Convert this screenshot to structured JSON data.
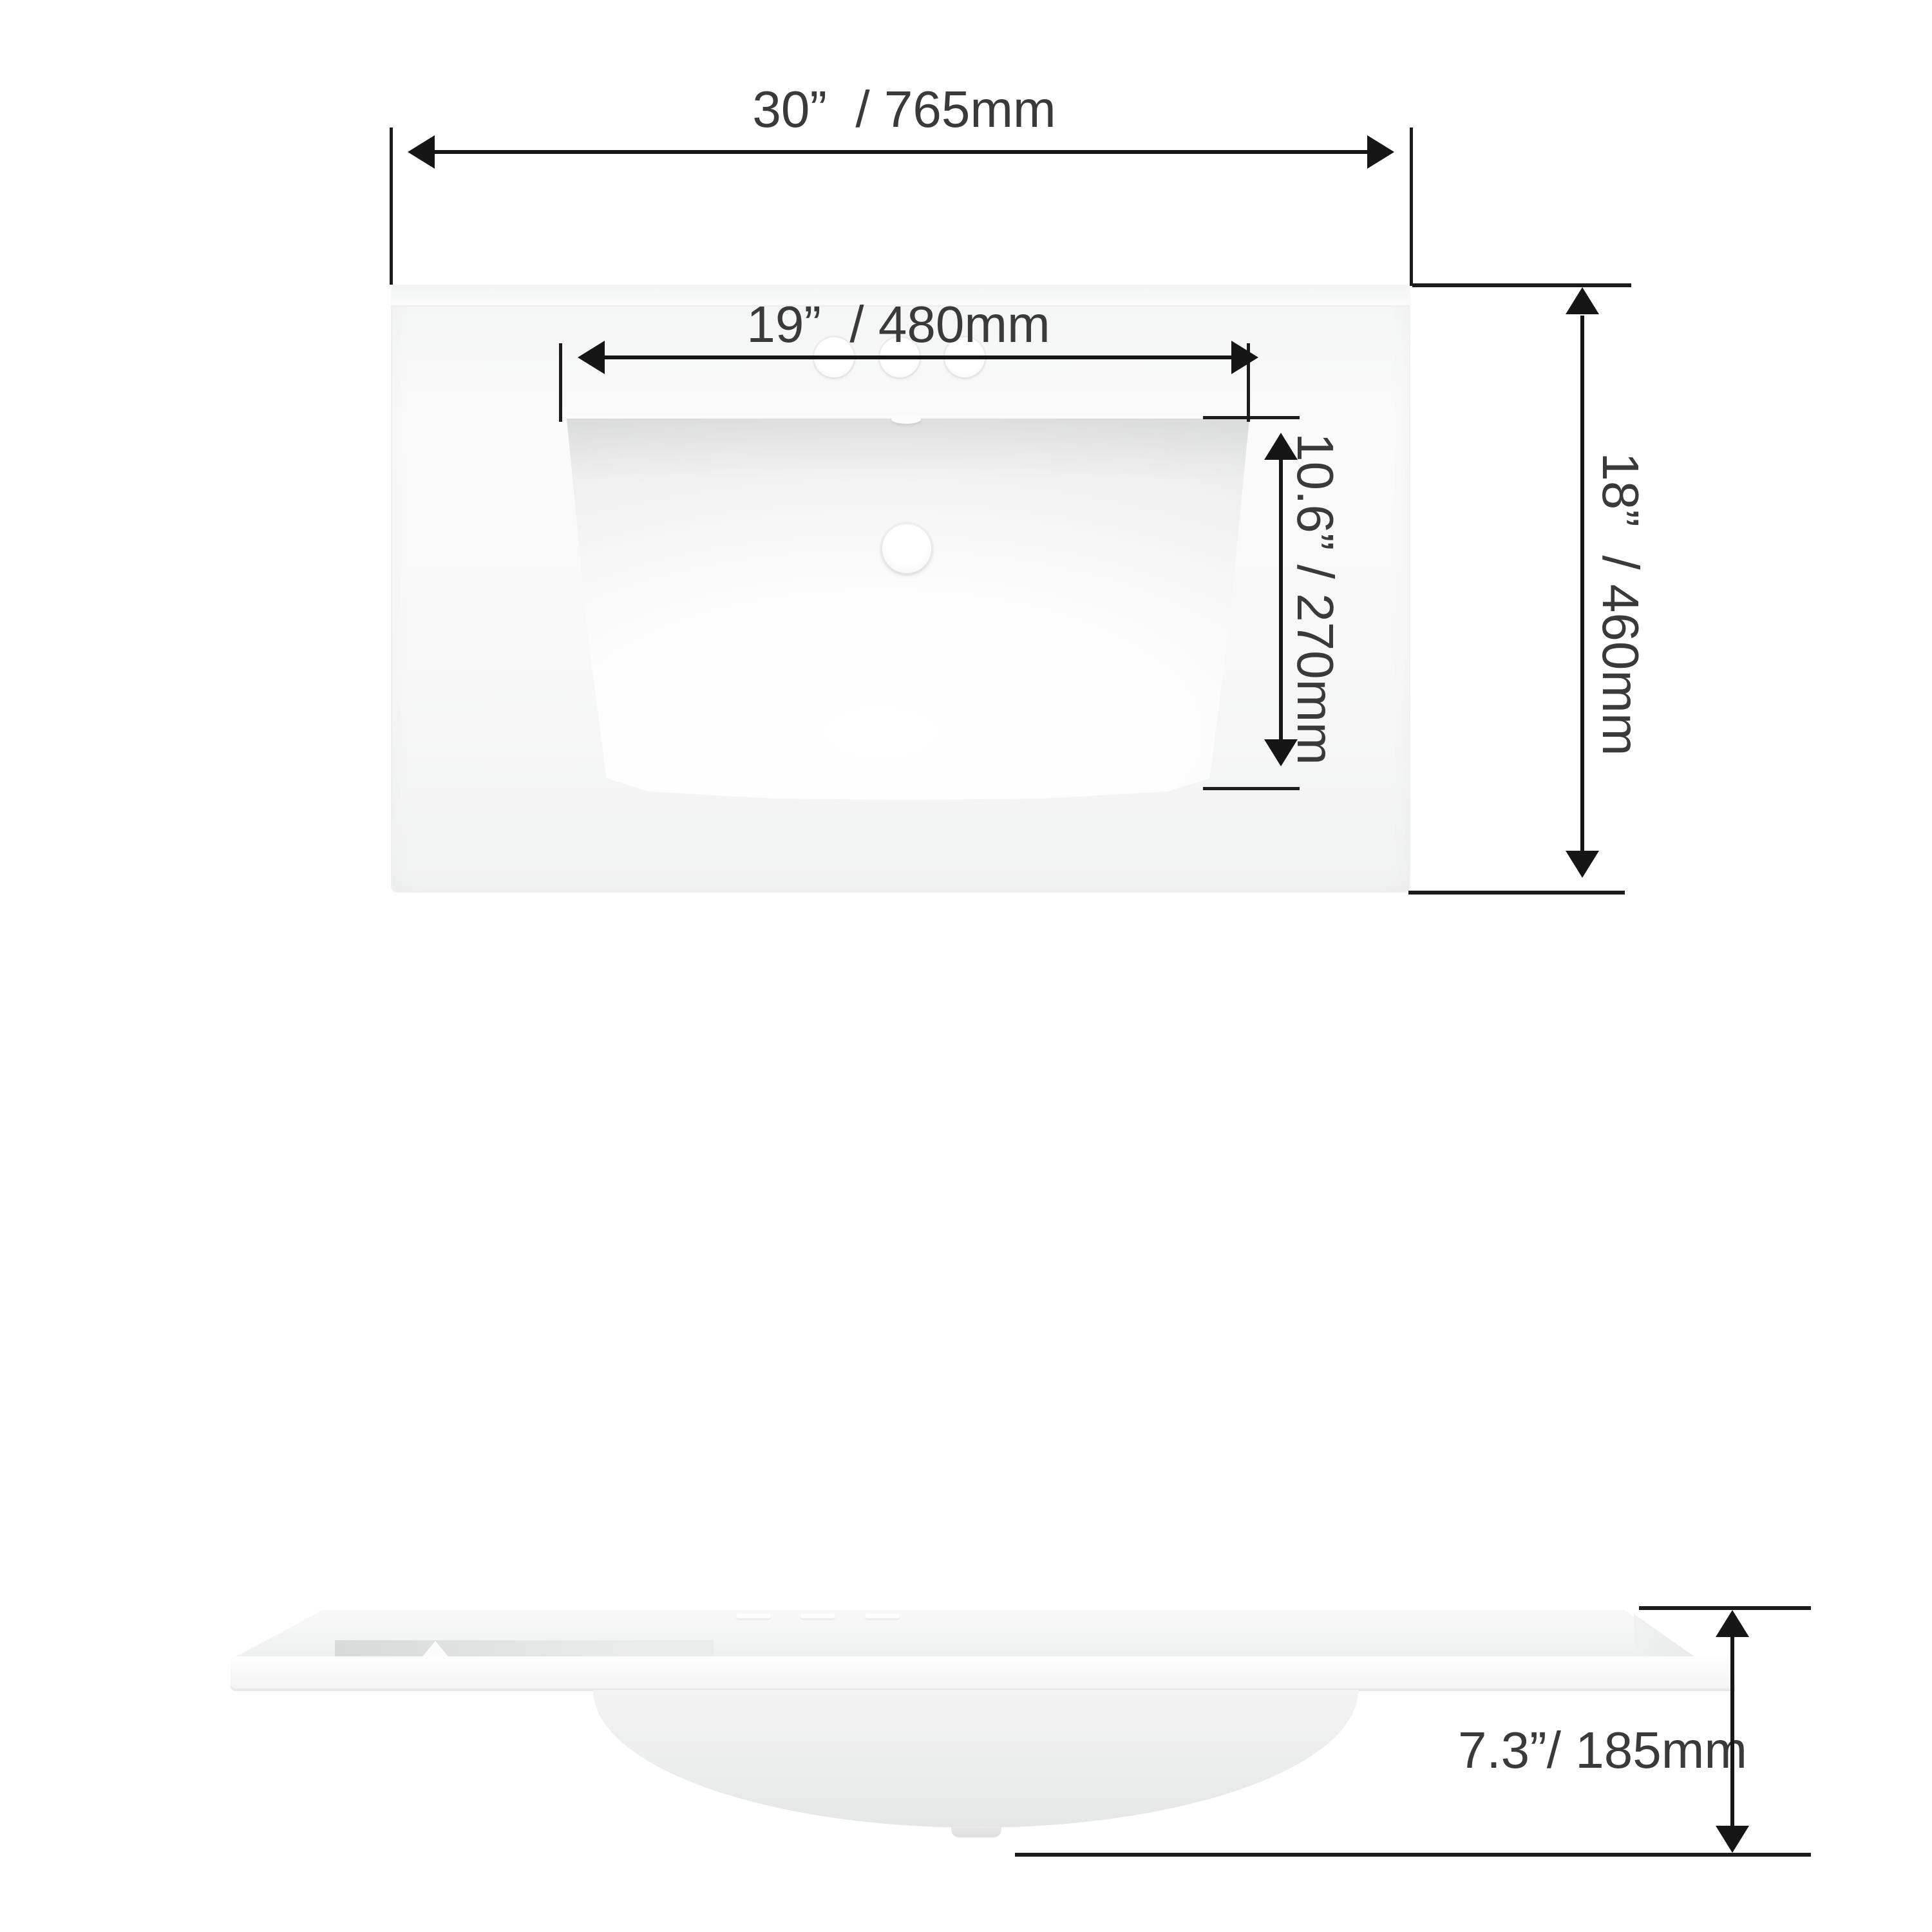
{
  "diagram": {
    "title": "Bathroom vanity sink top dimension diagram",
    "colors": {
      "background": "#ffffff",
      "dimension_line": "#161616",
      "label_text": "#3a3a3a",
      "ceramic_light": "#fbfbfb",
      "ceramic_shade": "#e6e6e6"
    },
    "top_view": {
      "dimensions": {
        "overall_width": {
          "inches": "30”",
          "mm": "765mm",
          "label": "30”  / 765mm"
        },
        "basin_width": {
          "inches": "19”",
          "mm": "480mm",
          "label": "19”  / 480mm"
        },
        "basin_depth": {
          "inches": "10.6”",
          "mm": "270mm",
          "label": "10.6” / 270mm"
        },
        "overall_depth": {
          "inches": "18”",
          "mm": "460mm",
          "label": "18”  / 460mm"
        }
      },
      "features": {
        "faucet_hole_count": 3,
        "drain_hole_count": 1,
        "overflow_notch_count": 1
      }
    },
    "side_view": {
      "dimensions": {
        "overall_height": {
          "inches": "7.3”",
          "mm": "185mm",
          "label": "7.3”/ 185mm"
        }
      },
      "features": {
        "backsplash": true,
        "under_bowl": true,
        "drain_stub": true
      }
    }
  }
}
